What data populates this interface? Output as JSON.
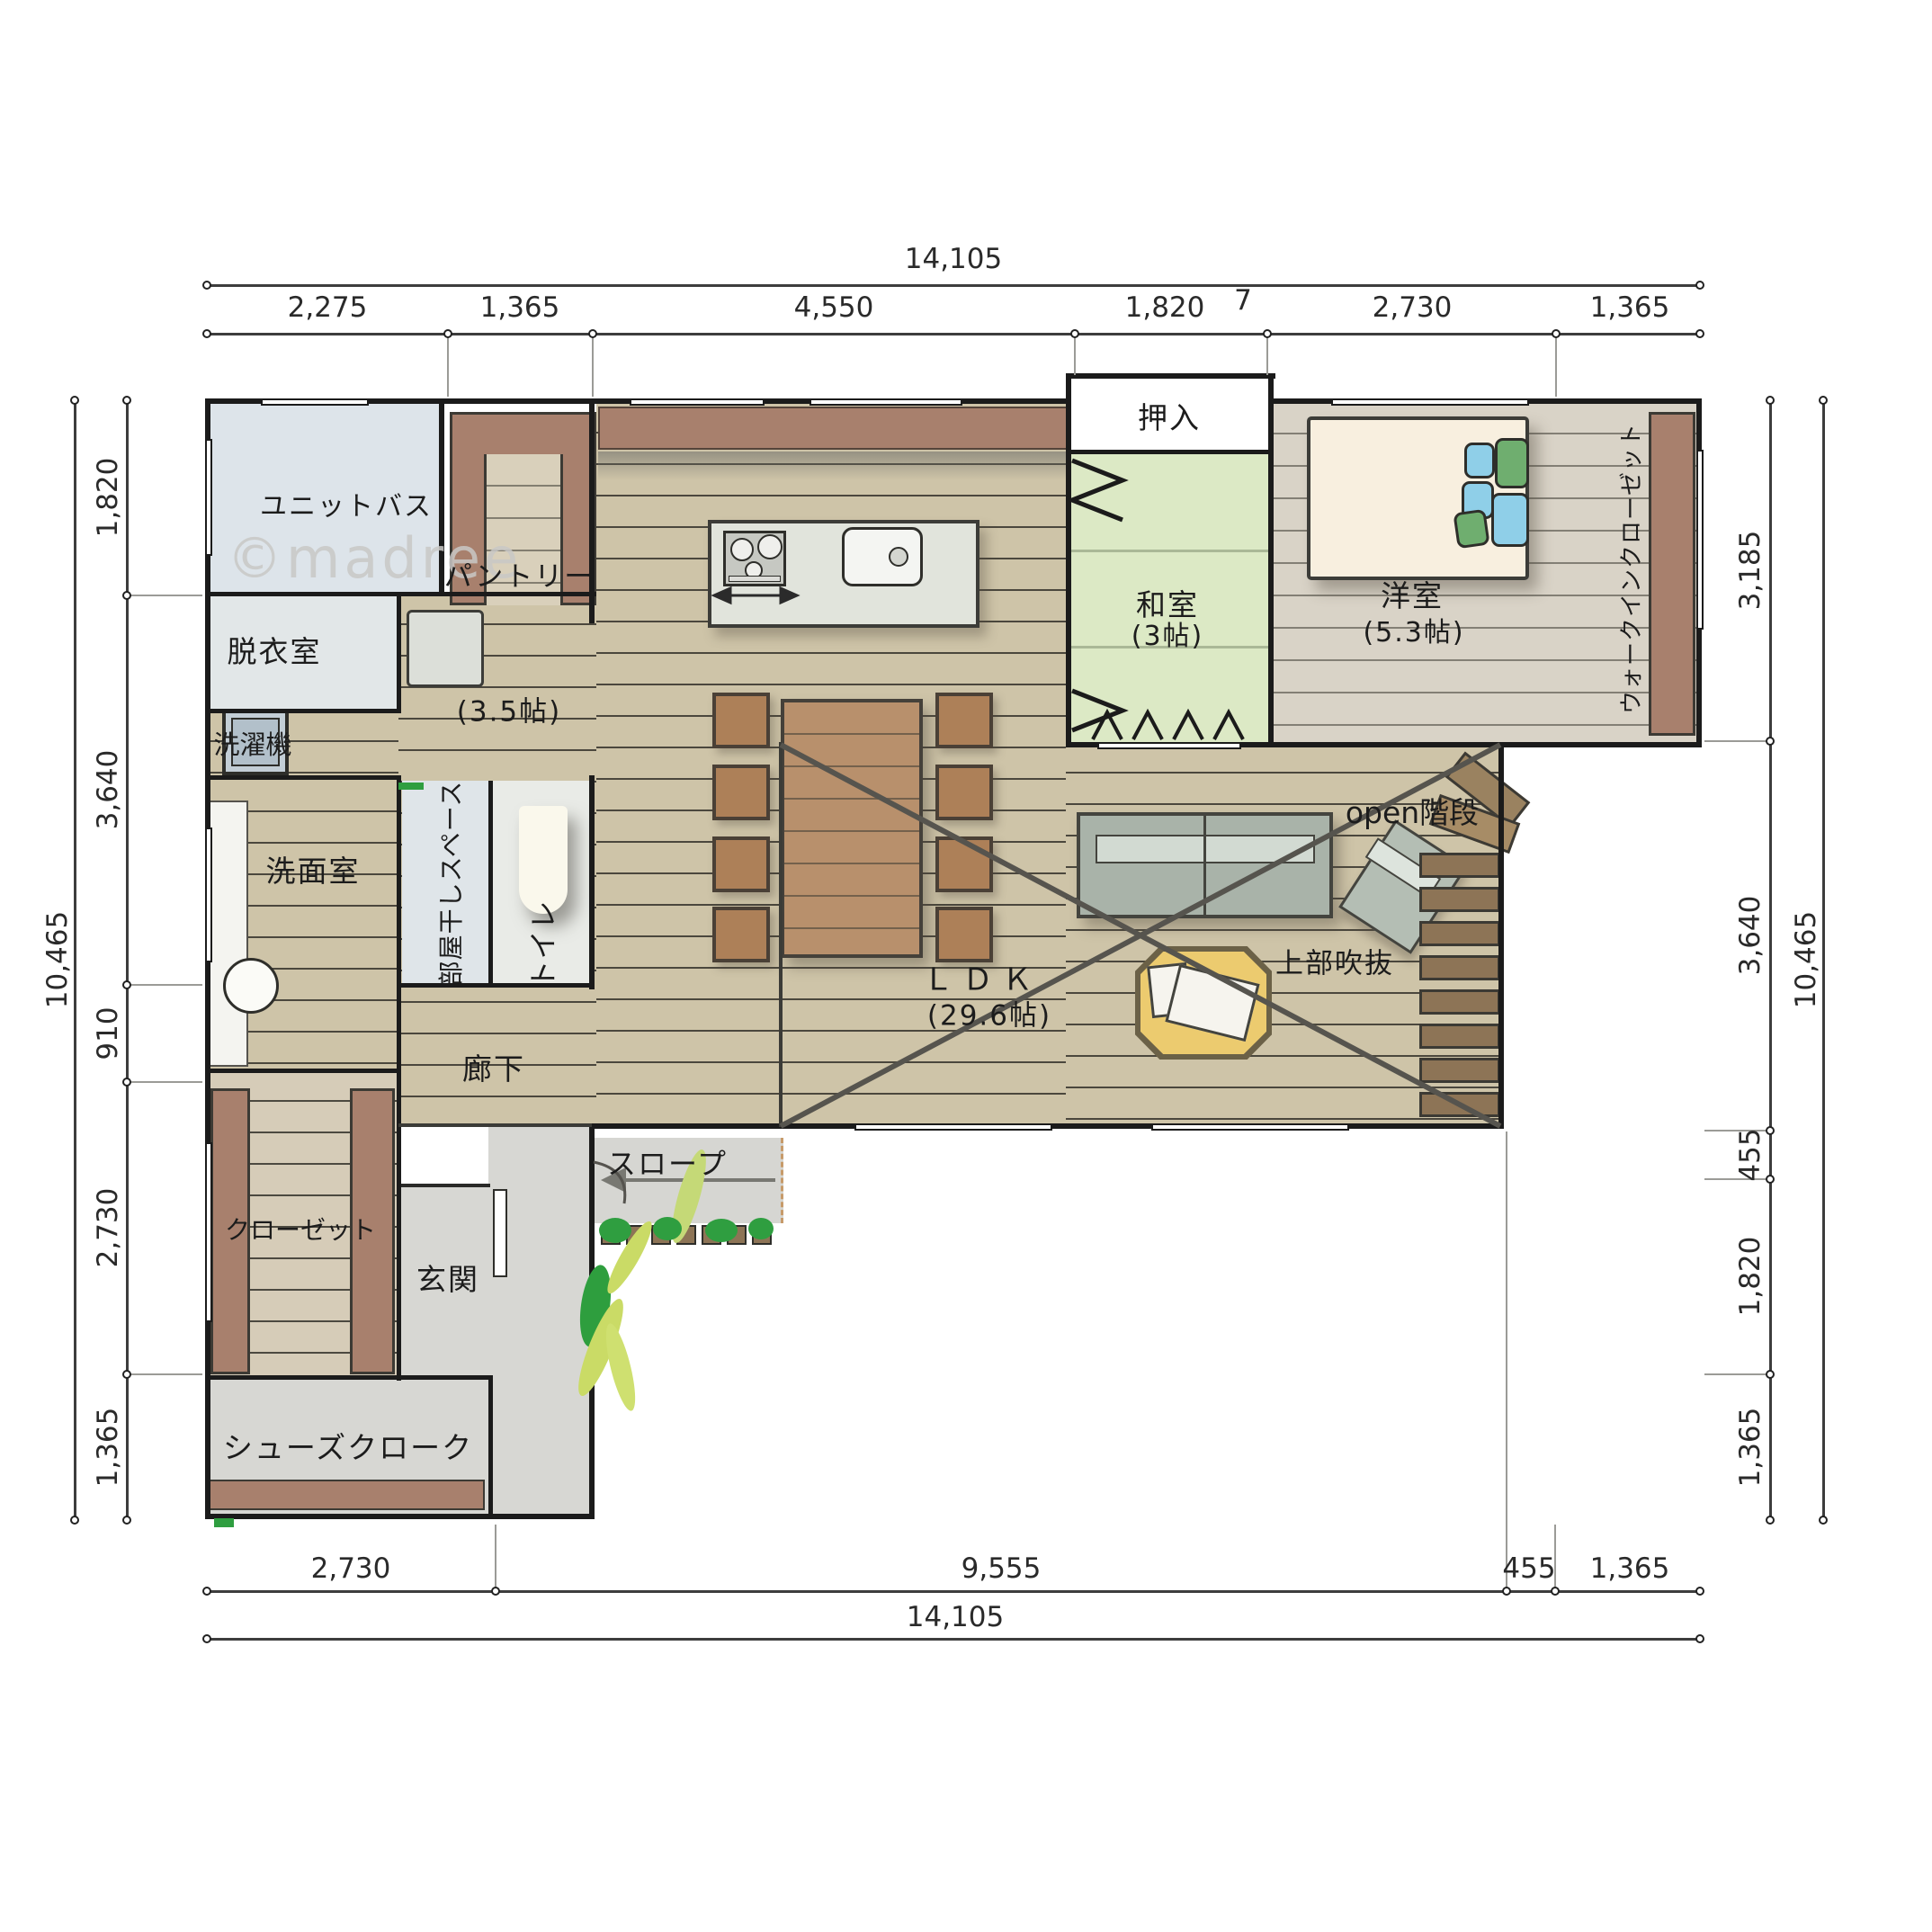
{
  "watermark": "©madree",
  "dims": {
    "top": {
      "total": "14,105",
      "segs": [
        "2,275",
        "1,365",
        "4,550",
        "1,820",
        "2,730",
        "1,365"
      ],
      "stray": "7"
    },
    "bottom": {
      "total": "14,105",
      "segs": [
        "2,730",
        "9,555",
        "455",
        "1,365"
      ]
    },
    "left": {
      "total": "10,465",
      "segs": [
        "1,820",
        "3,640",
        "910",
        "2,730",
        "1,365"
      ]
    },
    "right": {
      "total": "10,465",
      "segs": [
        "3,185",
        "3,640",
        "455",
        "1,820",
        "1,365"
      ]
    }
  },
  "rooms": {
    "unit_bath": "ユニットバス",
    "dressing": "脱衣室",
    "washer": "洗濯機",
    "pantry": "パントリー",
    "pantry_size": "(3.5帖)",
    "washroom": "洗面室",
    "drying": "部屋干しスペース",
    "toilet": "トイレ",
    "hallway": "廊下",
    "oshiire": "押入",
    "washitsu": "和室",
    "washitsu_size": "(3帖)",
    "youshitsu": "洋室",
    "youshitsu_size": "(5.3帖)",
    "wic": "ウォークインクローゼット",
    "ldk": "ＬＤＫ",
    "ldk_size": "(29.6帖)",
    "open_stairs": "open階段",
    "void_above": "上部吹抜",
    "closet": "クローゼット",
    "entrance": "玄関",
    "slope": "スロープ",
    "shoe_cloak": "シューズクローク"
  }
}
